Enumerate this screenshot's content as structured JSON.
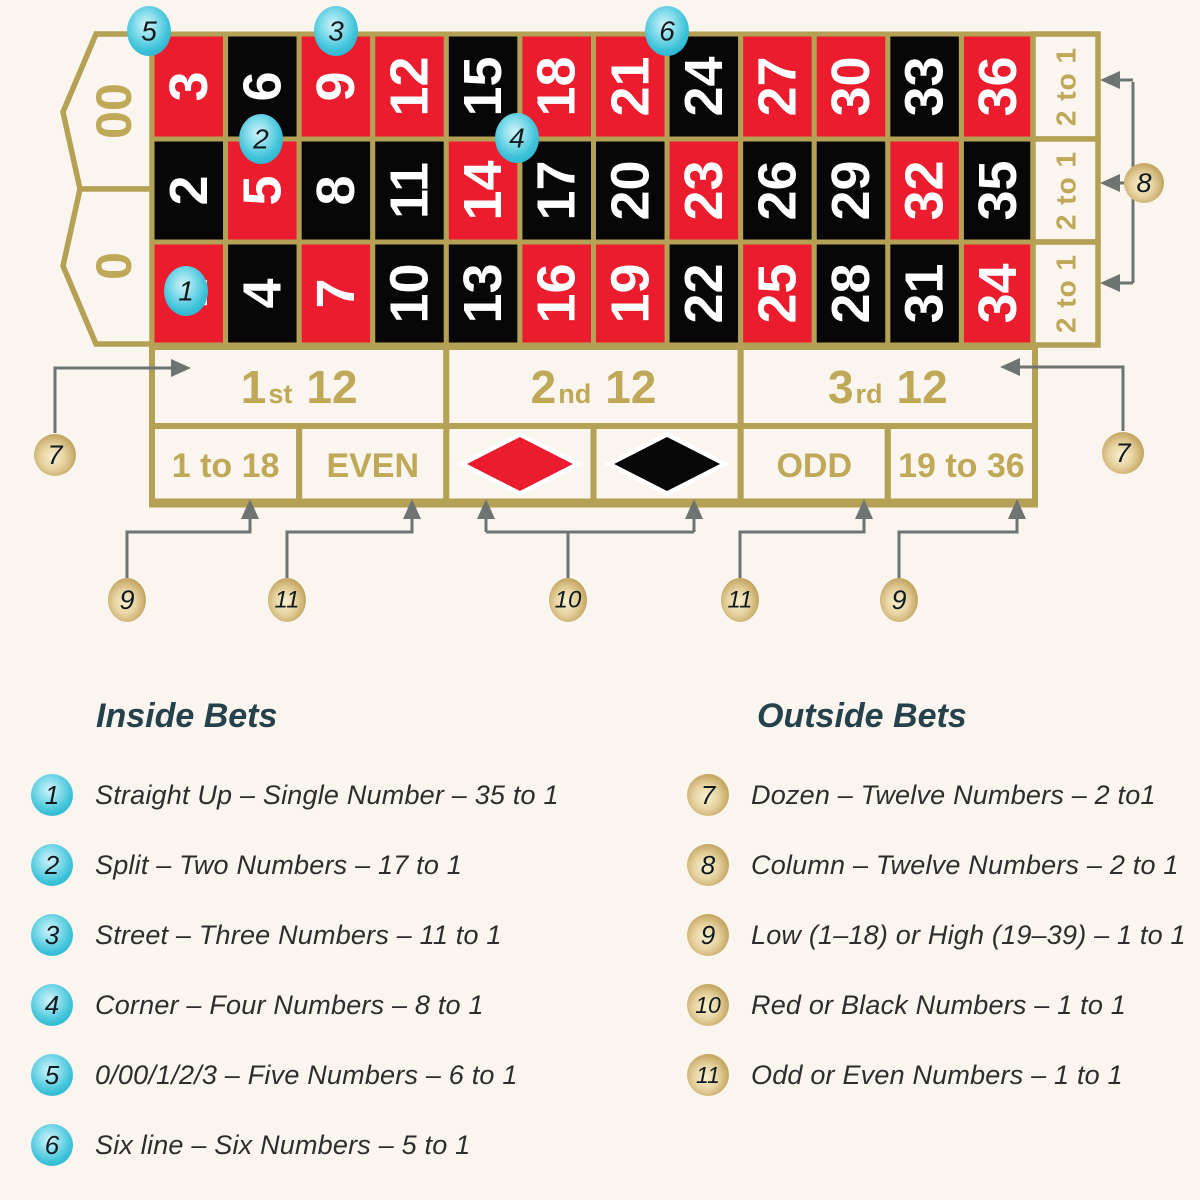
{
  "colors": {
    "background": "#faf5ee",
    "red": "#ea1c2d",
    "black": "#070707",
    "gold_line": "#b5a155",
    "gold_text": "#bfa857",
    "arrow": "#6d7471",
    "heading": "#25414c",
    "body_text": "#2d2d2d",
    "cyan_marker": "#3fc3da",
    "gold_marker": "#c2a35f"
  },
  "table": {
    "zeros": [
      {
        "label": "00"
      },
      {
        "label": "0"
      }
    ],
    "grid_rows": [
      [
        {
          "n": "3",
          "c": "red"
        },
        {
          "n": "6",
          "c": "black"
        },
        {
          "n": "9",
          "c": "red"
        },
        {
          "n": "12",
          "c": "red"
        },
        {
          "n": "15",
          "c": "black"
        },
        {
          "n": "18",
          "c": "red"
        },
        {
          "n": "21",
          "c": "red"
        },
        {
          "n": "24",
          "c": "black"
        },
        {
          "n": "27",
          "c": "red"
        },
        {
          "n": "30",
          "c": "red"
        },
        {
          "n": "33",
          "c": "black"
        },
        {
          "n": "36",
          "c": "red"
        }
      ],
      [
        {
          "n": "2",
          "c": "black"
        },
        {
          "n": "5",
          "c": "red"
        },
        {
          "n": "8",
          "c": "black"
        },
        {
          "n": "11",
          "c": "black"
        },
        {
          "n": "14",
          "c": "red"
        },
        {
          "n": "17",
          "c": "black"
        },
        {
          "n": "20",
          "c": "black"
        },
        {
          "n": "23",
          "c": "red"
        },
        {
          "n": "26",
          "c": "black"
        },
        {
          "n": "29",
          "c": "black"
        },
        {
          "n": "32",
          "c": "red"
        },
        {
          "n": "35",
          "c": "black"
        }
      ],
      [
        {
          "n": "1",
          "c": "red"
        },
        {
          "n": "4",
          "c": "black"
        },
        {
          "n": "7",
          "c": "red"
        },
        {
          "n": "10",
          "c": "black"
        },
        {
          "n": "13",
          "c": "black"
        },
        {
          "n": "16",
          "c": "red"
        },
        {
          "n": "19",
          "c": "red"
        },
        {
          "n": "22",
          "c": "black"
        },
        {
          "n": "25",
          "c": "red"
        },
        {
          "n": "28",
          "c": "black"
        },
        {
          "n": "31",
          "c": "black"
        },
        {
          "n": "34",
          "c": "red"
        }
      ]
    ],
    "column_bets": [
      {
        "label": "2 to 1"
      },
      {
        "label": "2 to 1"
      },
      {
        "label": "2 to 1"
      }
    ],
    "dozens": [
      {
        "num": "1",
        "suffix": "st",
        "rest": "12"
      },
      {
        "num": "2",
        "suffix": "nd",
        "rest": "12"
      },
      {
        "num": "3",
        "suffix": "rd",
        "rest": "12"
      }
    ],
    "outside_bets": [
      {
        "label": "1 to 18"
      },
      {
        "label": "EVEN"
      },
      {
        "diamond": "red"
      },
      {
        "diamond": "black"
      },
      {
        "label": "ODD"
      },
      {
        "label": "19 to 36"
      }
    ]
  },
  "markers": {
    "cyan": [
      {
        "label": "5"
      },
      {
        "label": "3"
      },
      {
        "label": "6"
      },
      {
        "label": "2"
      },
      {
        "label": "4"
      },
      {
        "label": "1"
      }
    ],
    "gold": [
      {
        "label": "8"
      },
      {
        "label": "7"
      },
      {
        "label": "7"
      },
      {
        "label": "9"
      },
      {
        "label": "11"
      },
      {
        "label": "10"
      },
      {
        "label": "11"
      },
      {
        "label": "9"
      }
    ]
  },
  "legend": {
    "inside": {
      "title": "Inside Bets",
      "items": [
        {
          "num": "1",
          "text": "Straight Up – Single Number – 35 to 1"
        },
        {
          "num": "2",
          "text": "Split – Two Numbers – 17 to 1"
        },
        {
          "num": "3",
          "text": "Street – Three Numbers – 11 to 1"
        },
        {
          "num": "4",
          "text": "Corner – Four Numbers – 8 to 1"
        },
        {
          "num": "5",
          "text": "0/00/1/2/3 – Five Numbers – 6 to 1"
        },
        {
          "num": "6",
          "text": "Six line – Six Numbers – 5 to 1"
        }
      ]
    },
    "outside": {
      "title": "Outside Bets",
      "items": [
        {
          "num": "7",
          "text": "Dozen – Twelve Numbers – 2 to1"
        },
        {
          "num": "8",
          "text": "Column – Twelve Numbers – 2 to 1"
        },
        {
          "num": "9",
          "text": "Low (1–18) or High (19–39) – 1 to 1"
        },
        {
          "num": "10",
          "text": "Red or Black Numbers – 1 to 1"
        },
        {
          "num": "11",
          "text": "Odd or Even Numbers – 1 to 1"
        }
      ]
    }
  }
}
